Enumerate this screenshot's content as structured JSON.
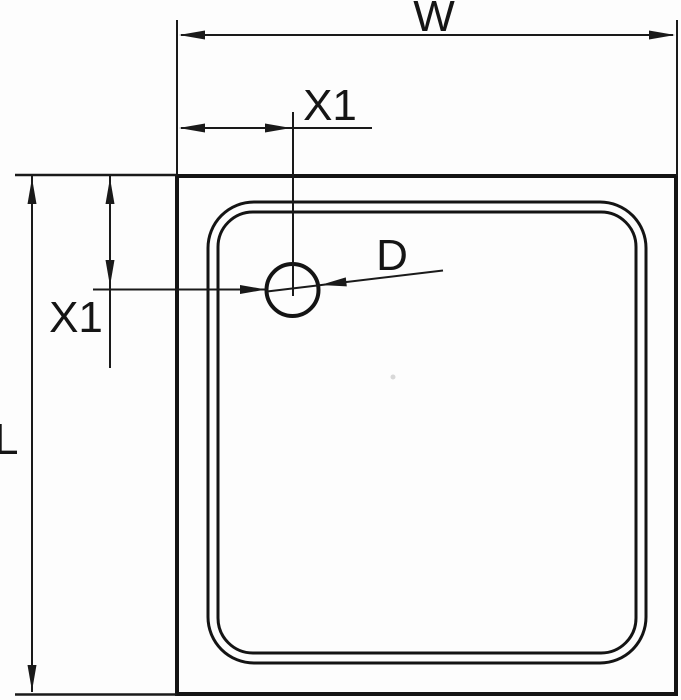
{
  "drawing": {
    "description": "Technical top-view dimension drawing of a square shower tray with offset drain hole",
    "background_color": "#fdfdfd",
    "line_color": "#141414",
    "labels": {
      "width": "W",
      "length": "L",
      "drain_offset_horizontal": "X1",
      "drain_offset_vertical": "X1",
      "drain_diameter": "D"
    }
  }
}
